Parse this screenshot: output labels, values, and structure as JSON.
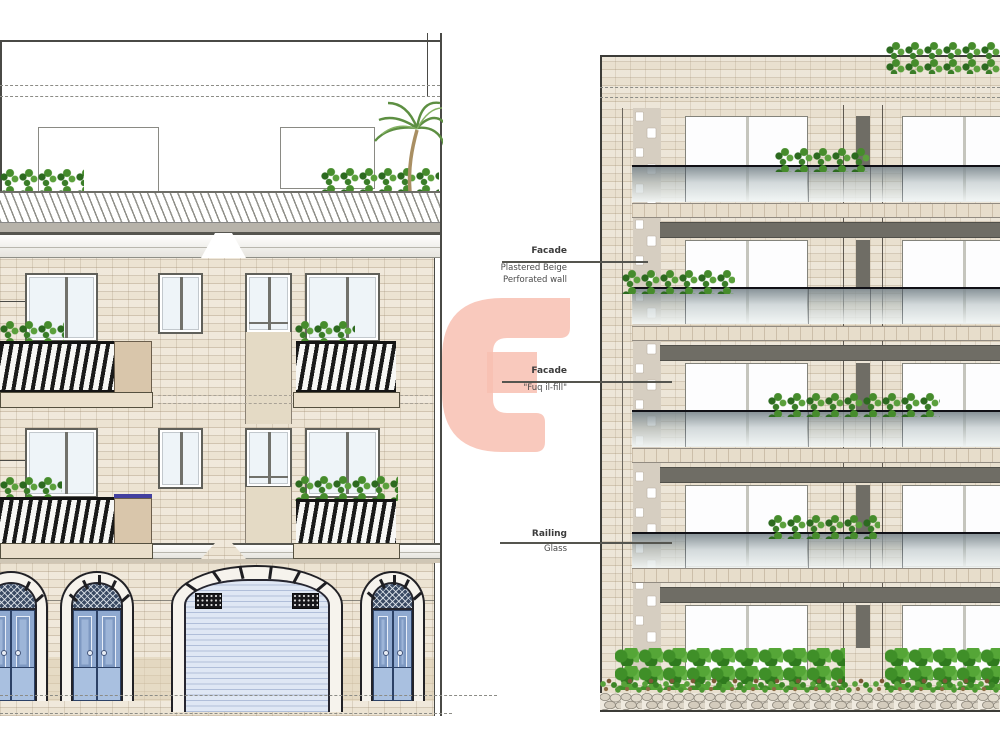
{
  "drawing": {
    "type": "architectural front elevations, existing and proposed",
    "annotations": [
      {
        "title": "Facade",
        "lines": [
          "Plastered Beige",
          "Perforated wall"
        ]
      },
      {
        "title": "Facade",
        "lines": [
          "\"Fuq il-fill\""
        ]
      },
      {
        "title": "Railing",
        "lines": [
          "Glass"
        ]
      }
    ],
    "watermark": {
      "letter": "G",
      "color": "#f8c3b5"
    },
    "palette": {
      "paper": "#ffffff",
      "brick_left": "#ece3d2",
      "brick_right": "#e9e0cf",
      "slab_grey": "#6f6d65",
      "glass_rail_top": "#7c888e",
      "glass_rail_bottom": "#f2f6f5",
      "door_blue": "#8fa9d0",
      "garage_door_blue": "#dfe7f4",
      "railing_black": "#191919",
      "balcony_panel_tan": "#d9c6ab",
      "hedge_green": "#3f8f28",
      "line_ink": "#4a4a46"
    }
  }
}
